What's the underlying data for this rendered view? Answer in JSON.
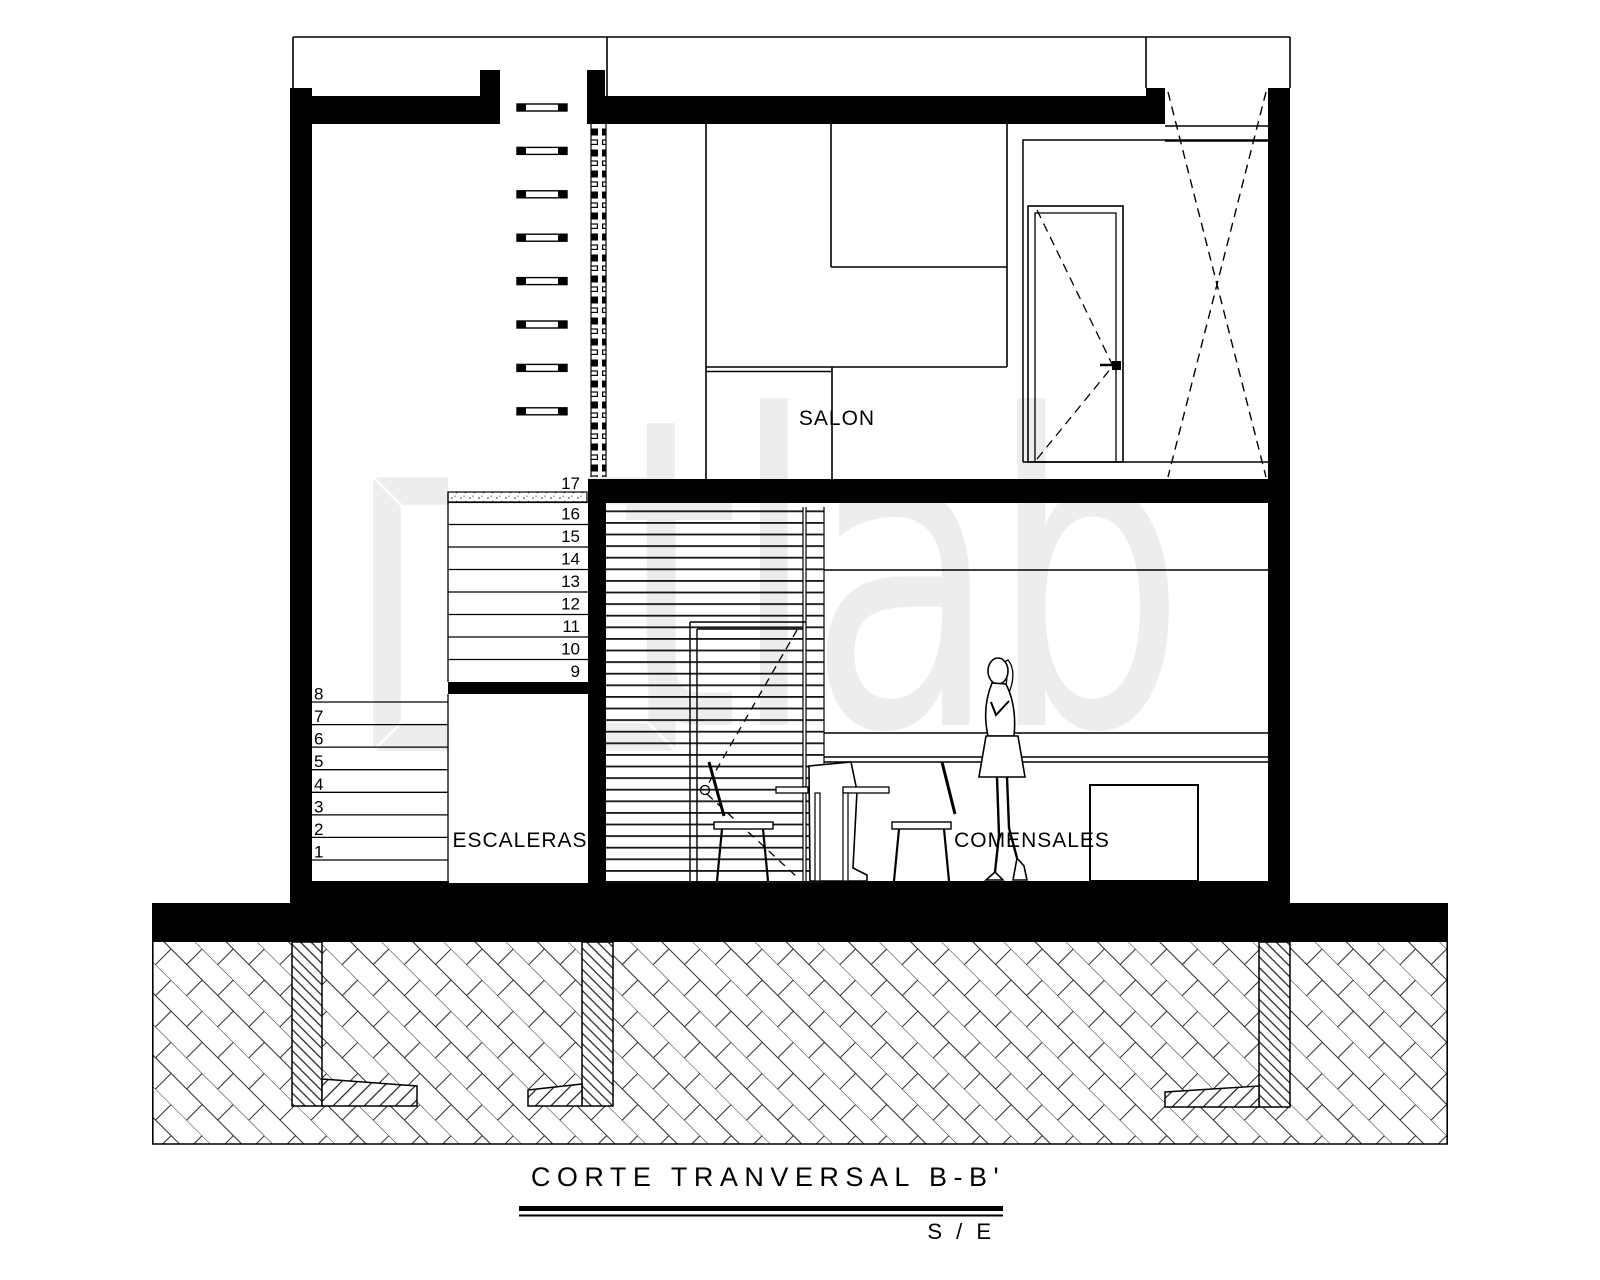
{
  "sheet": {
    "background": "#ffffff",
    "ink": "#000000",
    "watermark_text": "tlab",
    "watermark_color": "#ededed"
  },
  "labels": {
    "salon": "SALON",
    "escaleras": "ESCALERAS",
    "comensales": "COMENSALES"
  },
  "stairs": {
    "upper_numbers": [
      "17",
      "16",
      "15",
      "14",
      "13",
      "12",
      "11",
      "10",
      "9"
    ],
    "lower_numbers": [
      "8",
      "7",
      "6",
      "5",
      "4",
      "3",
      "2",
      "1"
    ]
  },
  "titleblock": {
    "title": "CORTE TRANVERSAL B-B'",
    "scale": "S / E"
  }
}
